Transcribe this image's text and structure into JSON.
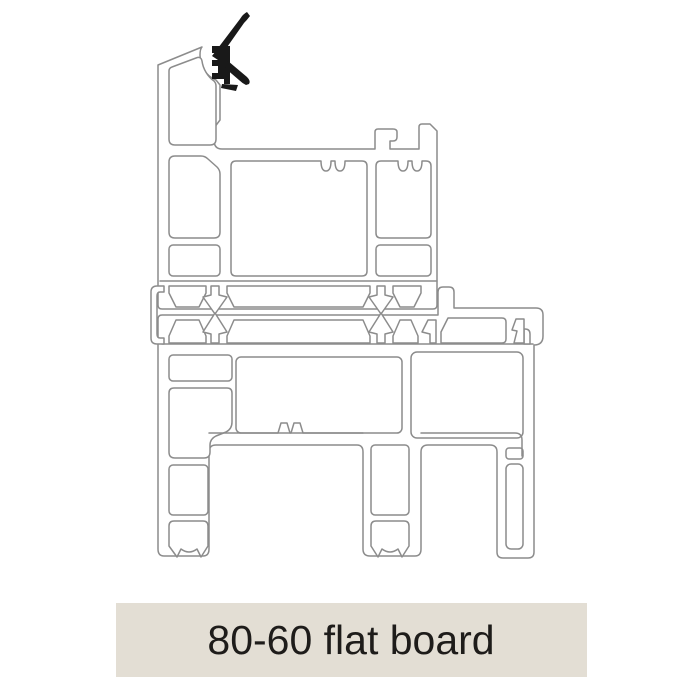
{
  "banner": {
    "label": "80-60 flat board"
  },
  "diagram": {
    "description": "Technical cross-section line drawing of an 80-60 flat board uPVC profile assembly",
    "parts": [
      "top-seal-gasket",
      "upper-sash-profile",
      "interlock-arrow-clips",
      "left-end-clip",
      "lower-frame-profile"
    ]
  },
  "colors": {
    "line": "#8c8c8c",
    "gasket": "#191919",
    "banner_bg": "#e3ded4",
    "banner_text": "#1e1c1a",
    "page_bg": "#ffffff"
  }
}
